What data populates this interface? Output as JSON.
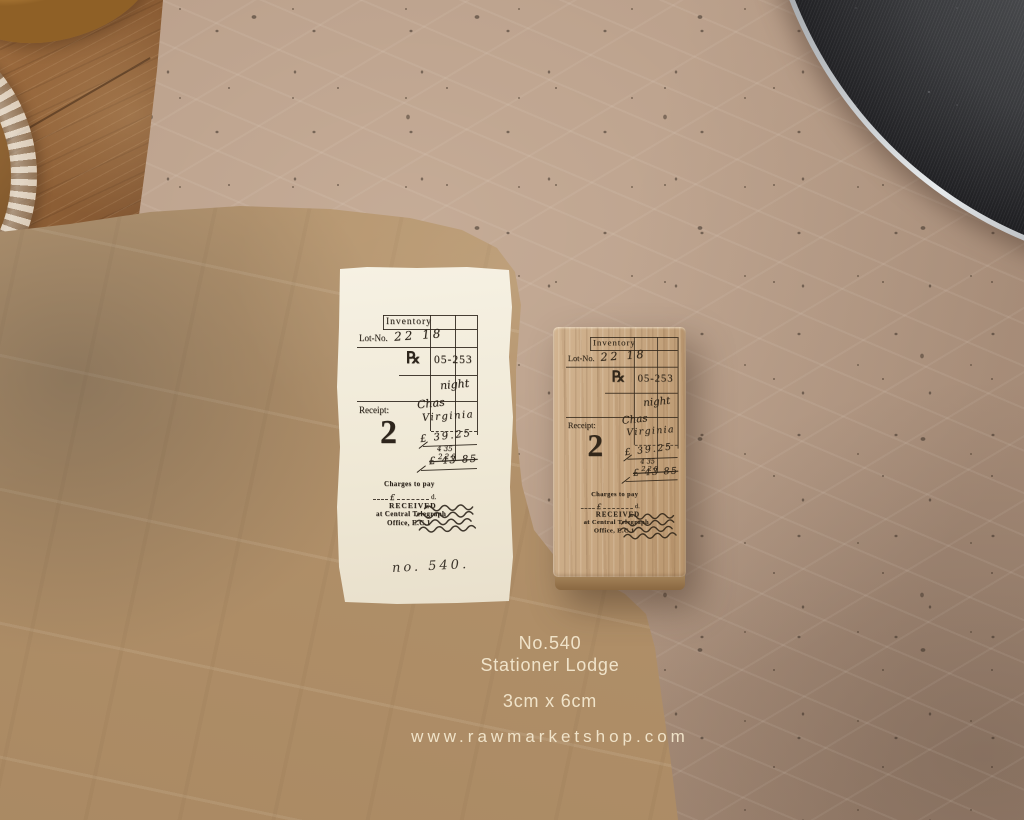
{
  "caption": {
    "product_no": "No.540",
    "product_name": "Stationer Lodge",
    "size": "3cm x 6cm",
    "website": "www.rawmarketshop.com"
  },
  "stamp_design": {
    "inventory": "Inventory",
    "lot_label": "Lot-No.",
    "lot_value": "22 18",
    "rx": "℞",
    "code": "05-253",
    "night": "night",
    "receipt_label": "Receipt:",
    "script_1": "Chas",
    "script_2": "Virginia",
    "big_number": "2",
    "sum_1": "£ 39.25",
    "sum_2": "4 35",
    "sum_3": "2 2 0",
    "sum_total": "£ 43 85",
    "charges": "Charges to pay",
    "charges_pound": "£",
    "charges_pence": "d.",
    "received": "RECEIVED",
    "received_at": "at Central Telegraph",
    "received_office": "Office, E.C.1"
  },
  "paper": {
    "handwritten_no": "no. 540."
  },
  "colors": {
    "ink": "#2d251c",
    "kraft_paper": "#b2916a",
    "background_paper": "#b59a85",
    "stamp_wood": "#c5a47e",
    "table_wood": "#8a5c34",
    "tray": "#1d1d20",
    "tray_rim": "#e7eaec",
    "caption_text": "#f0e3c9",
    "receipt_paper": "#f2ecdc"
  }
}
